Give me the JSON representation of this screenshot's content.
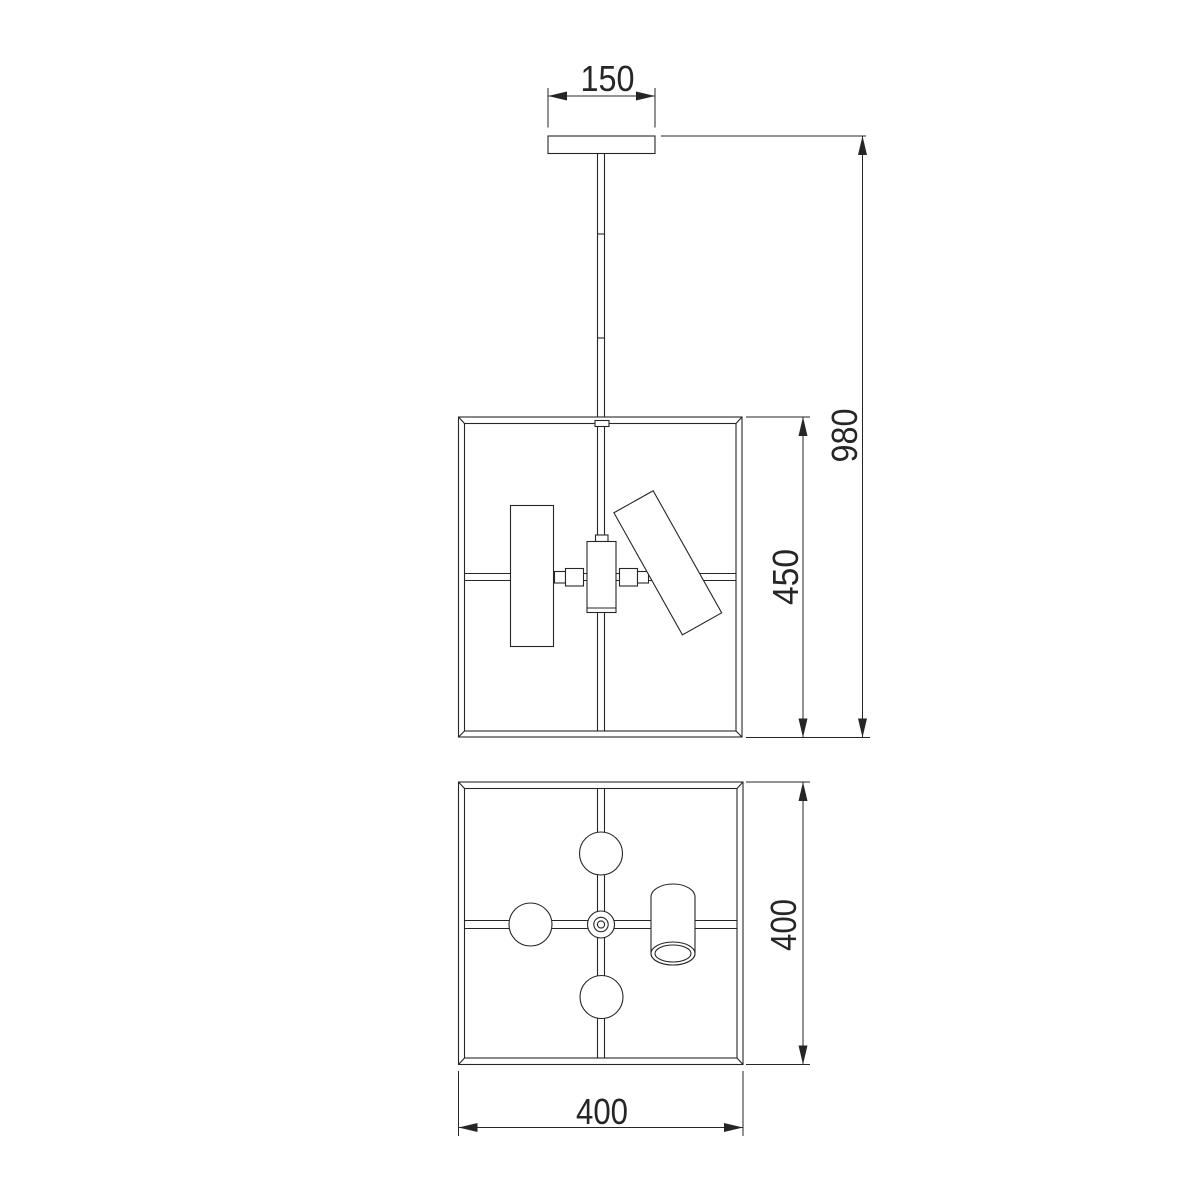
{
  "drawing": {
    "kind": "technical-dimension-drawing",
    "subject": "pendant-ceiling-lamp-two-views",
    "background_color": "#ffffff",
    "line_color": "#262626",
    "views": {
      "front_view": "elevation-with-canopy-rod-frame-and-spots",
      "plan_view": "bottom-view-with-four-spots-on-cross-arms"
    },
    "labels": {
      "canopy_width": "150",
      "overall_height": "980",
      "frame_height": "450",
      "frame_plan_height": "400",
      "frame_plan_width": "400"
    }
  }
}
